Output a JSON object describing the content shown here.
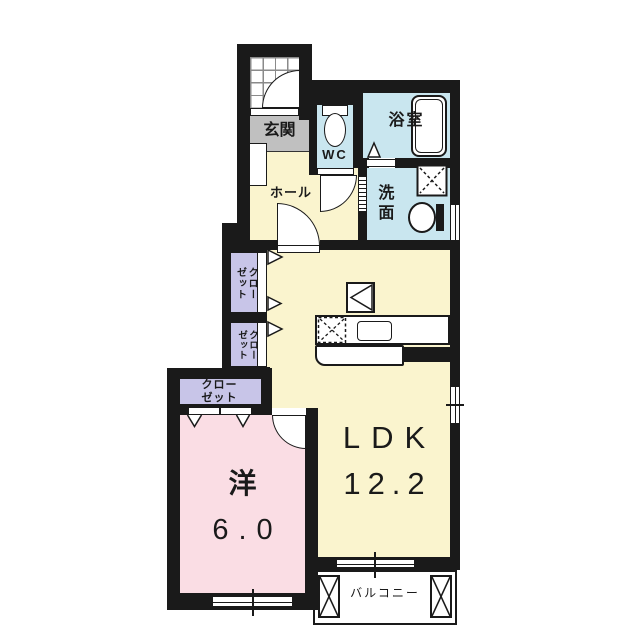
{
  "document": {
    "type": "japanese-apartment-floor-plan",
    "total_layout": "1LDK"
  },
  "colors": {
    "wall": "#1a1a1a",
    "floor_main": "#faf4ce",
    "floor_bedroom": "#fadde4",
    "closet": "#c8c5e8",
    "water_area": "#c9e6ef",
    "entrance_gray": "#c0c0c0",
    "white": "#ffffff"
  },
  "rooms": {
    "entrance": {
      "label": "玄関"
    },
    "toilet": {
      "label": "WC"
    },
    "bathroom": {
      "label": "浴室"
    },
    "washroom": {
      "label": "洗面"
    },
    "hall": {
      "label": "ホール"
    },
    "closet_upper": {
      "line1": "クロー",
      "line2": "ゼット"
    },
    "closet_lower": {
      "line1": "クロー",
      "line2": "ゼット"
    },
    "closet_bedroom": {
      "line1": "クロー",
      "line2": "ゼット"
    },
    "bedroom": {
      "label": "洋",
      "size": "6.0"
    },
    "ldk": {
      "label": "LDK",
      "size": "12.2"
    },
    "balcony": {
      "label": "バルコニー"
    }
  },
  "symbols": {
    "entrance_door": "swing-door",
    "interior_doors": "swing-doors",
    "bathroom_door": "fold-door-triangle",
    "washroom_door": "sliding-door",
    "toilet": "toilet-with-tank",
    "bathtub": "bathtub",
    "washing_machine": "washing-machine-pan-x",
    "wash_basin": "oval-basin",
    "stove": "dashed-x-stove",
    "kitchen_sink": "rounded-sink",
    "refrigerator": "refrigerator-space-triangle",
    "windows": "double-line-sliding-windows",
    "balcony_marks": "x-hatch-boxes",
    "closet_doors": "triangle-open-markers"
  }
}
